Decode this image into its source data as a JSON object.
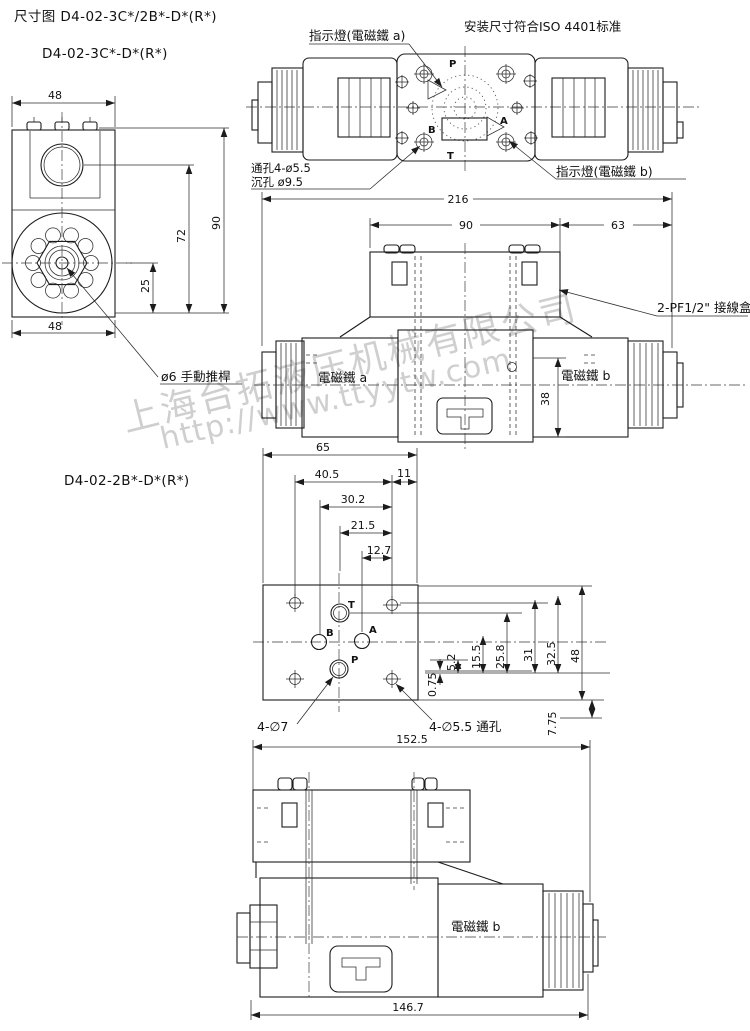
{
  "header": {
    "title": "尺寸图 D4-02-3C*/2B*-D*(R*)"
  },
  "variant_a_label": "D4-02-3C*-D*(R*)",
  "variant_b_label": "D4-02-2B*-D*(R*)",
  "watermark": {
    "line1": "上海台拓液压机械有限公司",
    "line2": "http://www.ttyytw.com",
    "color": "#c7c7c7"
  },
  "top_view": {
    "iso_note": "安装尺寸符合ISO 4401标准",
    "indicator_a": "指示燈(電磁鐵 a)",
    "indicator_b": "指示燈(電磁鐵 b)",
    "hole_note_1": "通孔4-ø5.5",
    "hole_note_2": "沉孔 ø9.5",
    "port_p": "P",
    "port_a": "A",
    "port_b": "B",
    "port_t": "T"
  },
  "front_view": {
    "dim_top_width": "48",
    "dim_bottom_width": "48",
    "dim_height": "90",
    "dim_port_height": "72",
    "dim_center_height": "25",
    "manual_rod": "ø6 手動推桿"
  },
  "side_view": {
    "dim_total": "216",
    "dim_left": "90",
    "dim_right": "63",
    "dim_height": "38",
    "junction_box": "2-PF1/2\" 接線盒",
    "solenoid_a": "電磁鐵 a",
    "solenoid_b": "電磁鐵 b"
  },
  "plate_view": {
    "dim_width": "65",
    "dim_40_5": "40.5",
    "dim_11": "11",
    "dim_30_2": "30.2",
    "dim_21_5": "21.5",
    "dim_12_7": "12.7",
    "dim_0_75": "0.75",
    "dim_5_2": "5.2",
    "dim_15_5": "15.5",
    "dim_25_8": "25.8",
    "dim_31": "31",
    "dim_32_5": "32.5",
    "dim_48": "48",
    "dim_7_75": "7.75",
    "callout_port_holes": "4-∅7",
    "callout_bolt_holes": "4-∅5.5 通孔",
    "port_t": "T",
    "port_b": "B",
    "port_a": "A",
    "port_p": "P"
  },
  "bottom_view": {
    "dim_top": "152.5",
    "dim_bottom": "146.7",
    "solenoid_b": "電磁鐵 b"
  }
}
